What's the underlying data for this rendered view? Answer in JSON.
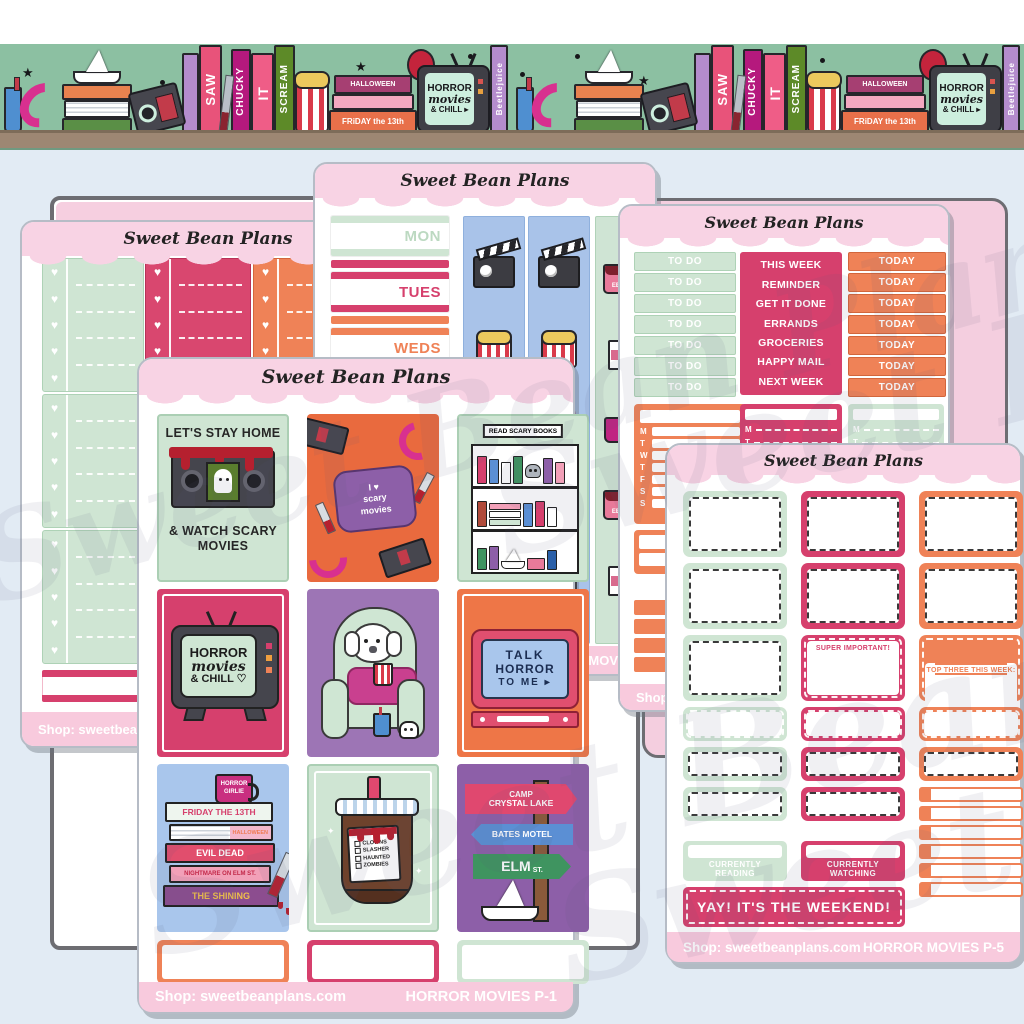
{
  "brand": "Sweet Bean Plans",
  "watermark_text": "Sweet Bean Plans",
  "banner": {
    "book_saw": "SAW",
    "book_chucky": "CHUCKY",
    "book_it": "IT",
    "book_scream": "SCREAM",
    "book_beetlejuice": "Beetlejuice",
    "book_halloween": "HALLOWEEN",
    "book_friday": "FRiDAY the 13th",
    "tv_line1": "HORROR",
    "tv_line2": "movies",
    "tv_line3": "& CHILL ▸"
  },
  "sheets": {
    "left": {
      "shop": "Shop: sweetbeanpl"
    },
    "dates": {
      "days": [
        "MON",
        "TUES",
        "WEDS",
        "THURS"
      ],
      "ticket_text": "ADMIT ONE",
      "mug_text": "EEK!",
      "code_fragment": "MOVIES"
    },
    "todo": {
      "todo_strips": [
        "TO DO",
        "TO DO",
        "TO DO",
        "TO DO",
        "TO DO",
        "TO DO",
        "TO DO"
      ],
      "labels": [
        "THIS WEEK",
        "REMINDER",
        "GET IT DONE",
        "ERRANDS",
        "GROCERIES",
        "HAPPY MAIL",
        "NEXT WEEK"
      ],
      "today_strips": [
        "TODAY",
        "TODAY",
        "TODAY",
        "TODAY",
        "TODAY",
        "TODAY",
        "TODAY"
      ],
      "week_letters": [
        "M",
        "T",
        "W",
        "T",
        "F",
        "S",
        "S"
      ],
      "mt_letters": [
        "M",
        "T"
      ],
      "shop": "Shop: s"
    },
    "p1": {
      "stay_home_title": "LET'S STAY HOME",
      "stay_home_sub": "& WATCH SCARY MOVIES",
      "pillow_line1": "I ♥",
      "pillow_line2": "scary",
      "pillow_line3": "movies",
      "bookshelf_sign": "READ SCARY BOOKS",
      "tv1_line1": "HORROR",
      "tv1_line2": "movies",
      "tv1_line3": "& CHILL ♡",
      "tv2_line1": "TALK",
      "tv2_line2": "HORROR",
      "tv2_line3": "TO ME ▸",
      "mug_text": "HORROR GIRLIE",
      "book_titles": [
        "FRIDAY THE 13TH",
        "HALLOWEEN",
        "EVIL DEAD",
        "NIGHTMARE ON ELM ST.",
        "THE SHINING"
      ],
      "drink_checklist": [
        "CLOWNS",
        "SLASHER",
        "HAUNTED",
        "ZOMBIES"
      ],
      "sign1_line1": "CAMP",
      "sign1_line2": "CRYSTAL LAKE",
      "sign2": "BATES MOTEL",
      "sign3_big": "ELM",
      "sign3_small": "ST.",
      "shop": "Shop: sweetbeanplans.com",
      "code": "HORROR MOVIES P-1"
    },
    "p5": {
      "super_important": "SUPER IMPORTANT!",
      "top_three": "TOP THREE THIS WEEK:",
      "currently_reading": "CURRENTLY READING",
      "currently_watching": "CURRENTLY WATCHING",
      "weekend": "YAY! IT'S THE WEEKEND!",
      "shop": "Shop: sweetbeanplans.com",
      "code": "HORROR MOVIES P-5"
    }
  }
}
